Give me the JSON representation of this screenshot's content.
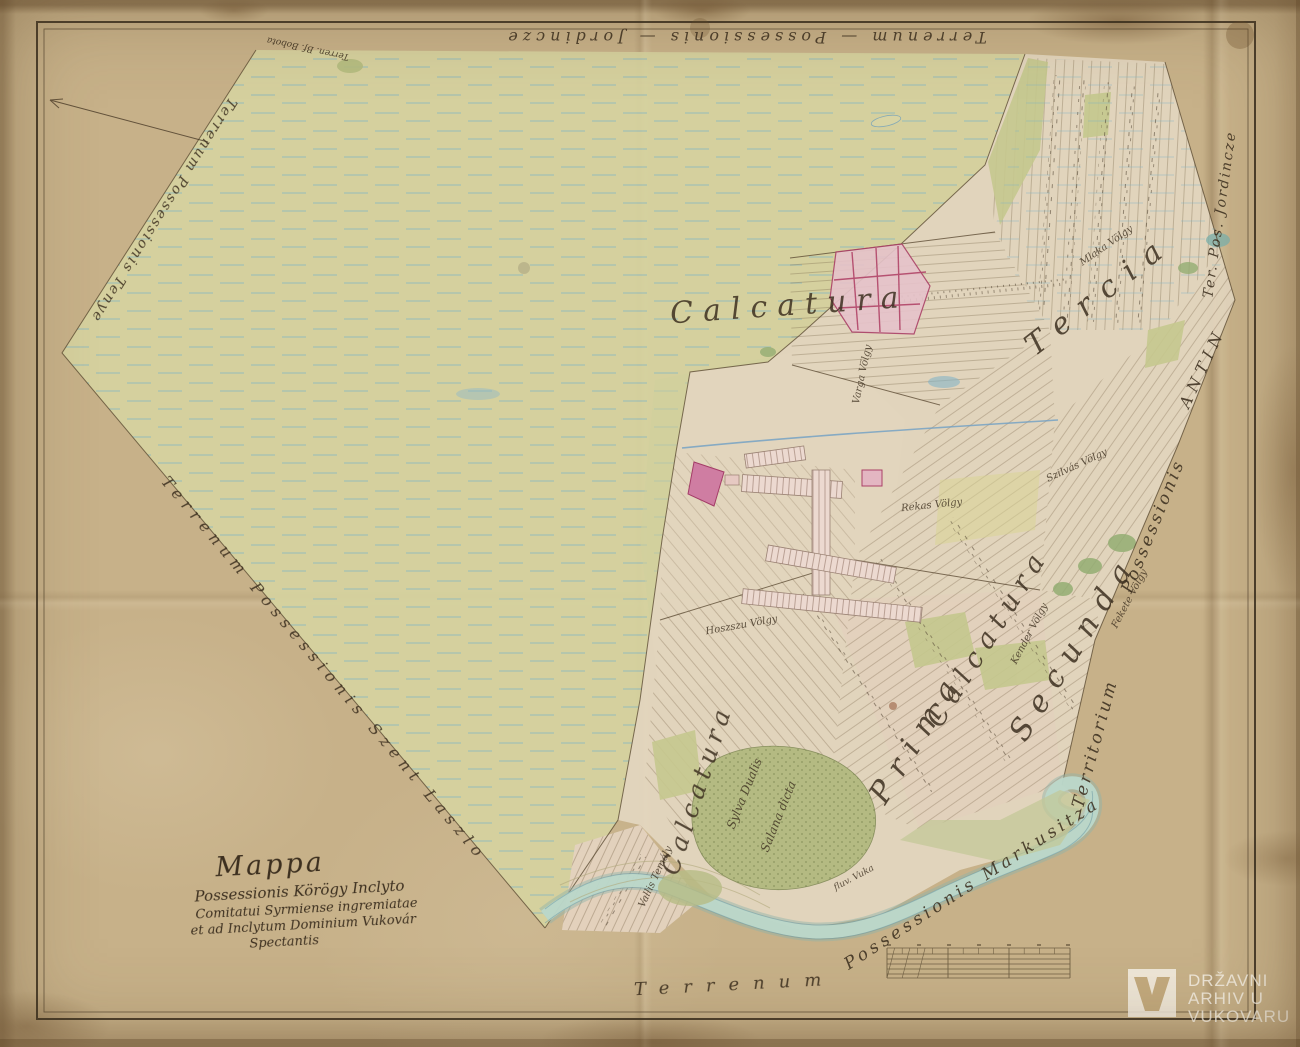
{
  "title_block": {
    "line1": "Mappa",
    "line2": "Possessionis Körögy Inclyto",
    "line3": "Comitatui Syrmiense ingremiatae",
    "line4": "et ad Inclytum Dominium Vukovár",
    "line5": "Spectantis"
  },
  "edge_labels": {
    "top": "Terrenum — Possessionis — Jordincze",
    "top_left_small": "Terren. Bf. Bobota",
    "upper_left": "Terrenum Possessionis Tenye",
    "lower_left": "Terrenum Possessionis Szent Laszlo",
    "bottom_left": "Terrenum",
    "bottom_right": "Possessionis Markusitza",
    "right_lower_a": "Territorium",
    "right_lower_b": "Possessionis",
    "right_lower_c": "ANTIN",
    "right_upper": "Ter. Pos. Jordincze"
  },
  "field_labels": {
    "calcatura_top": "Calcatura",
    "tercia": "Tercia",
    "calcatura_mid": "Calcatura",
    "secunda": "Secunda",
    "prima": "Prima",
    "calcatura_left": "Calcatura"
  },
  "parcel_labels": {
    "varga": "Varga Völgy",
    "mlaka": "Mlaka Völgy",
    "rekas": "Rekas Völgy",
    "hoszszu": "Hoszszu Völgy",
    "kender": "Kender Völgy",
    "fekete": "Fekete Völgy",
    "szilvas": "Szilvás Völgy",
    "sylva_a": "Sylva Dualis",
    "sylva_b": "Salana dicta",
    "vallis": "Vallis Temály",
    "river": "fluv. Vuka"
  },
  "watermark": {
    "line1": "DRŽAVNI",
    "line2": "ARHIV U",
    "line3": "VUKOVARU"
  },
  "colors": {
    "paper": "#c7b189",
    "ink": "#3c2f1f",
    "meadow": "#d6d2a0",
    "water_dash": "#7fb3c2",
    "river": "#bcd8ca",
    "village_fill": "#e6c3ca",
    "village_line": "#ab4168",
    "forest": "#b4ba82",
    "fields": "#e3d6bf"
  }
}
